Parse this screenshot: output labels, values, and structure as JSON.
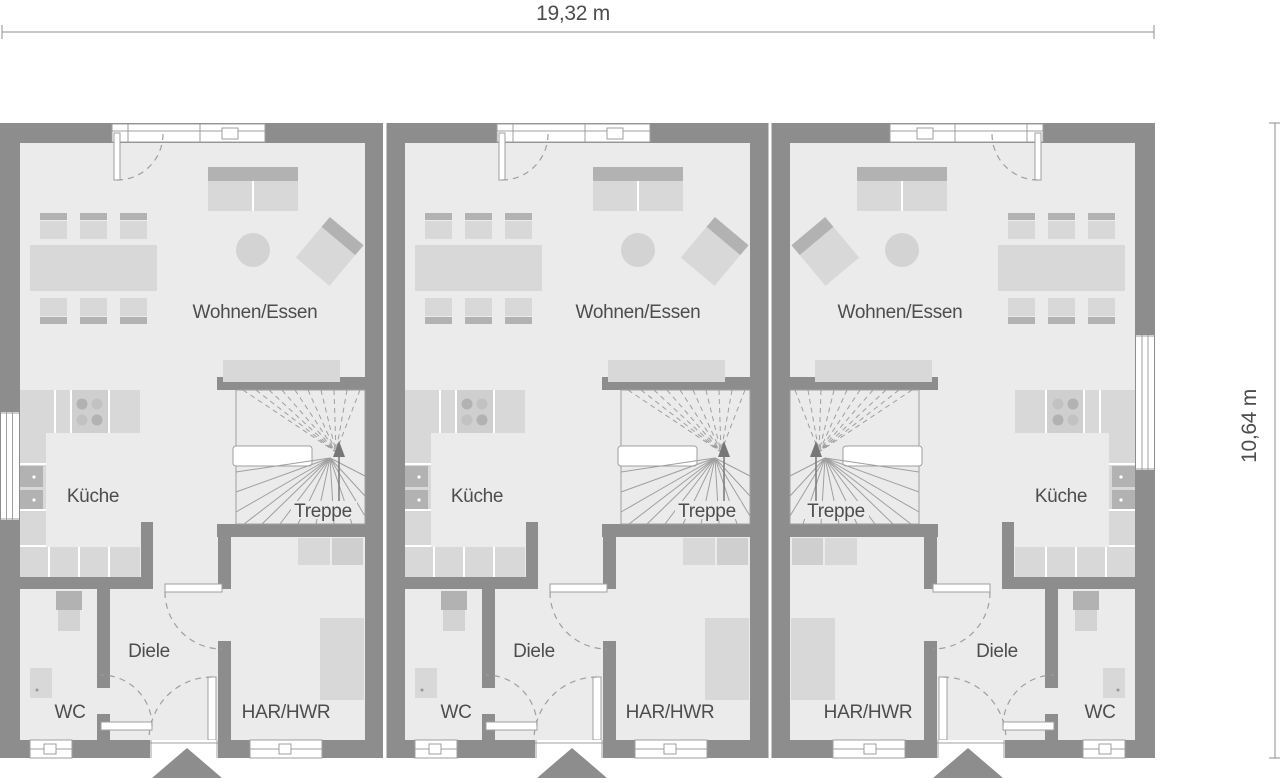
{
  "dimensions": {
    "width": "19,32 m",
    "height": "10,64 m"
  },
  "units": [
    {
      "name": "unit-1",
      "living": "Wohnen/Essen",
      "kitchen": "Küche",
      "stairs": "Treppe",
      "hall": "Diele",
      "wc": "WC",
      "utility": "HAR/HWR"
    },
    {
      "name": "unit-2",
      "living": "Wohnen/Essen",
      "kitchen": "Küche",
      "stairs": "Treppe",
      "hall": "Diele",
      "wc": "WC",
      "utility": "HAR/HWR"
    },
    {
      "name": "unit-3",
      "living": "Wohnen/Essen",
      "kitchen": "Küche",
      "stairs": "Treppe",
      "hall": "Diele",
      "wc": "WC",
      "utility": "HAR/HWR"
    }
  ],
  "colors": {
    "wall": "#8d8d8d",
    "floor": "#ebebeb",
    "furn": "#d8d8d8",
    "furnDark": "#b2b2b2",
    "mid": "#cfcfcf",
    "soft": "#d3d3d3",
    "line": "#9f9f9f",
    "dim": "#8f8f8f",
    "text": "#4d4d4d"
  }
}
